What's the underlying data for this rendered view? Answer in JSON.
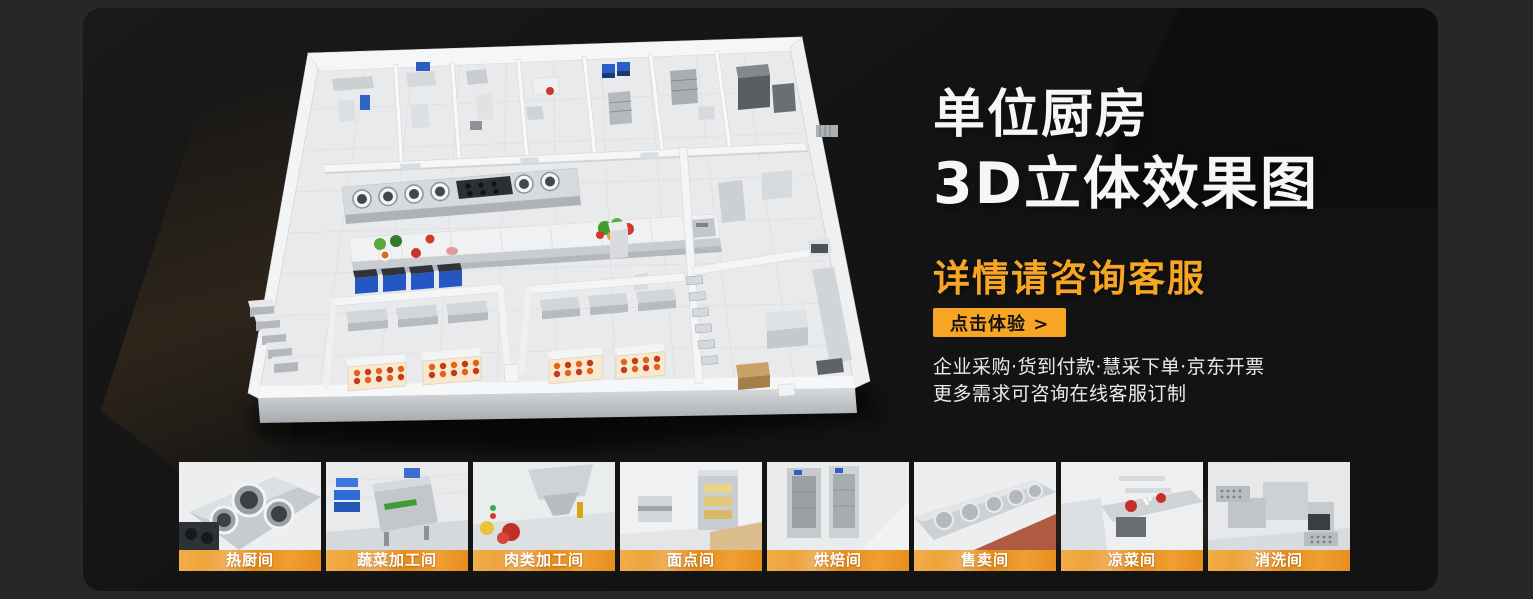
{
  "colors": {
    "outer_bg": "#272727",
    "panel_bg": "#141414",
    "accent_orange": "#F6A524",
    "headline_white": "#f6f6f6",
    "body_text": "#ebebeb",
    "button_text": "#171310",
    "label_grad_a": "#f1ae4b",
    "label_grad_b": "#e68e1d"
  },
  "hero": {
    "title_line1": "单位厨房",
    "title_line2": "3D立体效果图",
    "subtitle": "详情请咨询客服",
    "cta_label": "点击体验 >",
    "info_line1": "企业采购·货到付款·慧采下单·京东开票",
    "info_line2": "更多需求可咨询在线客服订制"
  },
  "gallery": {
    "items": [
      {
        "label": "热厨间"
      },
      {
        "label": "蔬菜加工间"
      },
      {
        "label": "肉类加工间"
      },
      {
        "label": "面点间"
      },
      {
        "label": "烘焙间"
      },
      {
        "label": "售卖间"
      },
      {
        "label": "凉菜间"
      },
      {
        "label": "消洗间"
      }
    ]
  }
}
